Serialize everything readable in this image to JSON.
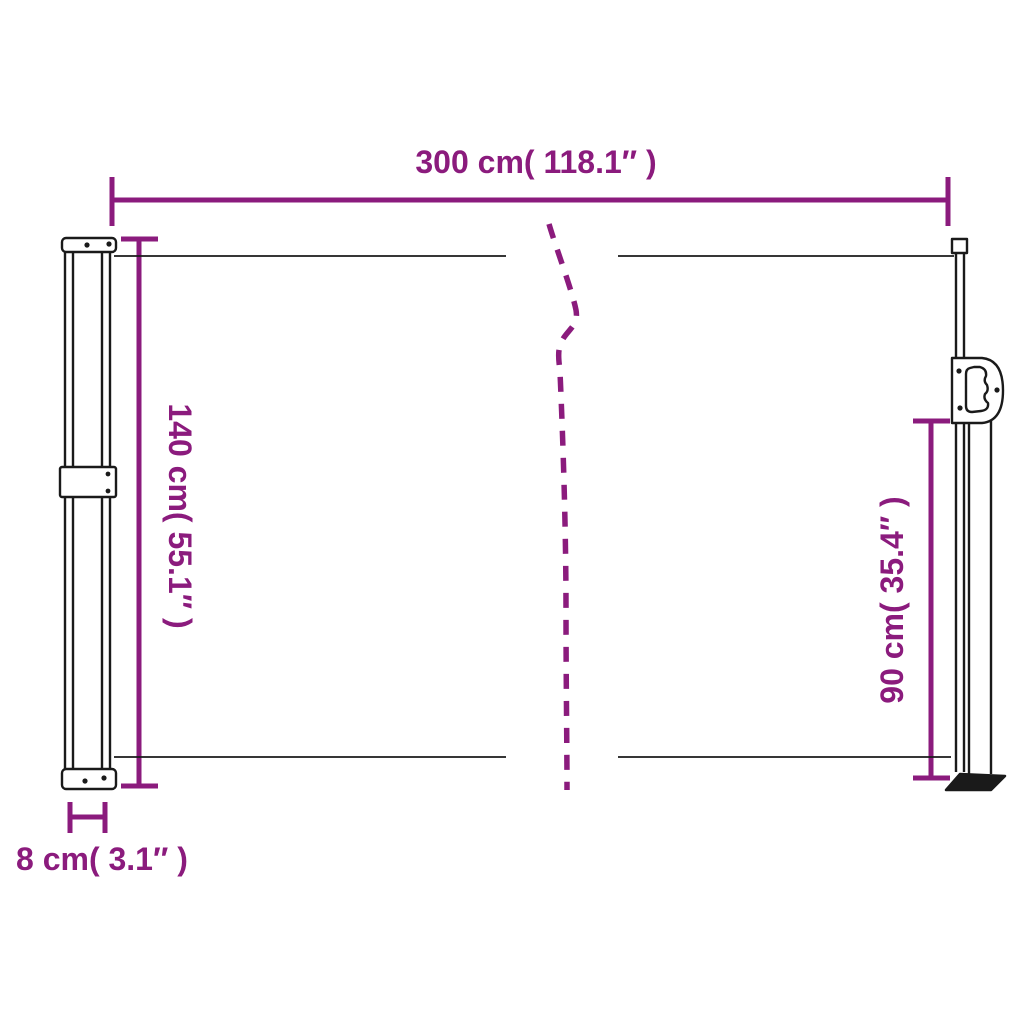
{
  "diagram": {
    "subject": "retractable-side-awning-dimension-diagram",
    "accent_color": "#8b1b7d",
    "outline_color": "#1a1a1a",
    "background_color": "#ffffff",
    "dimensions": {
      "width_top": "300 cm( 118.1″ )",
      "height_left": "140 cm( 55.1″ )",
      "height_right": "90 cm( 35.4″ )",
      "depth_bottom_left": "8 cm( 3.1″ )"
    }
  }
}
